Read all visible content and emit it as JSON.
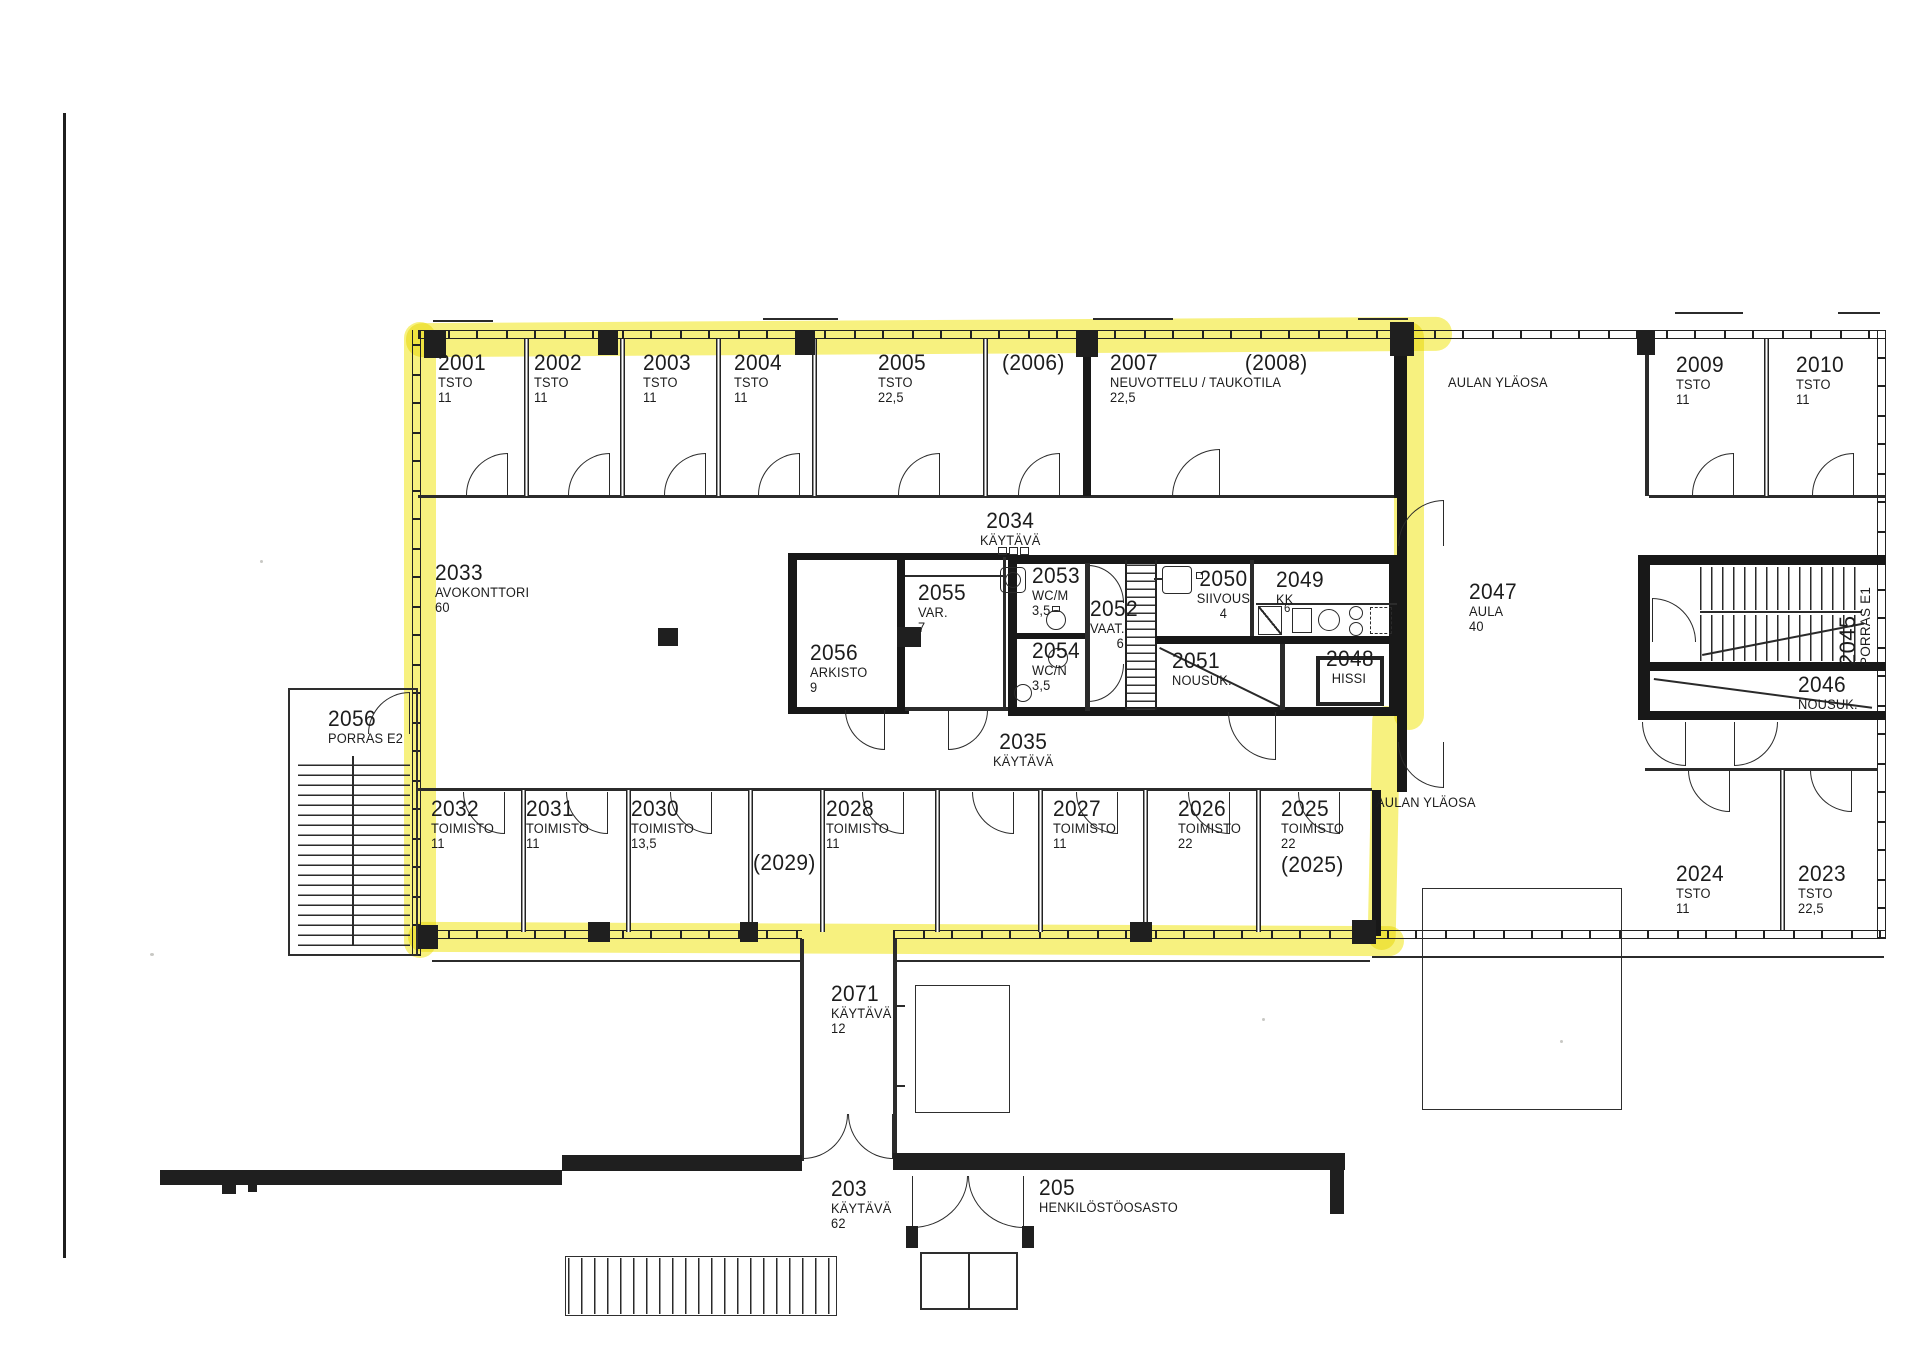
{
  "highlight_color": "#f2e829",
  "rooms": {
    "r2001": {
      "num": "2001",
      "line1": "TSTO",
      "line2": "11"
    },
    "r2002": {
      "num": "2002",
      "line1": "TSTO",
      "line2": "11"
    },
    "r2003": {
      "num": "2003",
      "line1": "TSTO",
      "line2": "11"
    },
    "r2004": {
      "num": "2004",
      "line1": "TSTO",
      "line2": "11"
    },
    "r2005": {
      "num": "2005",
      "line1": "TSTO",
      "line2": "22,5"
    },
    "r2006": {
      "num": "(2006)"
    },
    "r2007": {
      "num": "2007",
      "num2": "(2008)",
      "line1": "NEUVOTTELU / TAUKOTILA",
      "line2": "22,5"
    },
    "r2009": {
      "num": "2009",
      "line1": "TSTO",
      "line2": "11"
    },
    "r2010": {
      "num": "2010",
      "line1": "TSTO",
      "line2": "11"
    },
    "aulan_ylaosa_top": {
      "text": "AULAN YLÄOSA"
    },
    "r2033": {
      "num": "2033",
      "line1": "AVOKONTTORI",
      "line2": "60"
    },
    "r2034": {
      "num": "2034",
      "line1": "KÄYTÄVÄ"
    },
    "r2056_arkisto": {
      "num": "2056",
      "line1": "ARKISTO",
      "line2": "9"
    },
    "r2055": {
      "num": "2055",
      "line1": "VAR.",
      "line2": "7"
    },
    "r2053": {
      "num": "2053",
      "line1": "WC/M",
      "line2": "3,5"
    },
    "r2054": {
      "num": "2054",
      "line1": "WC/N",
      "line2": "3,5"
    },
    "r2052": {
      "num": "2052",
      "line1": "VAAT.",
      "line2": "6"
    },
    "r2050": {
      "num": "2050",
      "line1": "SIIVOUS",
      "line2": "4"
    },
    "r2049": {
      "num": "2049",
      "line1": "KK"
    },
    "kk_detail": {
      "text": "6"
    },
    "r2051": {
      "num": "2051",
      "line1": "NOUSUK."
    },
    "r2048": {
      "num": "2048",
      "line1": "HISSI"
    },
    "r2047": {
      "num": "2047",
      "line1": "AULA",
      "line2": "40"
    },
    "r2045": {
      "num": "2045",
      "line1": "PORRAS E1"
    },
    "r2046": {
      "num": "2046",
      "line1": "NOUSUK."
    },
    "r2056_porras": {
      "num": "2056",
      "line1": "PORRAS E2"
    },
    "r2035": {
      "num": "2035",
      "line1": "KÄYTÄVÄ"
    },
    "r2032": {
      "num": "2032",
      "line1": "TOIMISTO",
      "line2": "11"
    },
    "r2031": {
      "num": "2031",
      "line1": "TOIMISTO",
      "line2": "11"
    },
    "r2030": {
      "num": "2030",
      "line1": "TOIMISTO",
      "line2": "13,5"
    },
    "r2029": {
      "num": "(2029)"
    },
    "r2028": {
      "num": "2028",
      "line1": "TOIMISTO",
      "line2": "11"
    },
    "r2027": {
      "num": "2027",
      "line1": "TOIMISTO",
      "line2": "11"
    },
    "r2026": {
      "num": "2026",
      "line1": "TOIMISTO",
      "line2": "22"
    },
    "r2025": {
      "num": "2025",
      "line1": "TOIMISTO",
      "line2": "22",
      "alt": "(2025)"
    },
    "aulan_ylaosa_bottom": {
      "text": "AULAN YLÄOSA"
    },
    "r2024": {
      "num": "2024",
      "line1": "TSTO",
      "line2": "11"
    },
    "r2023": {
      "num": "2023",
      "line1": "TSTO",
      "line2": "22,5"
    },
    "r2071": {
      "num": "2071",
      "line1": "KÄYTÄVÄ",
      "line2": "12"
    },
    "r203": {
      "num": "203",
      "line1": "KÄYTÄVÄ",
      "line2": "62"
    },
    "r205": {
      "num": "205",
      "line1": "HENKILÖSTÖOSASTO"
    }
  }
}
